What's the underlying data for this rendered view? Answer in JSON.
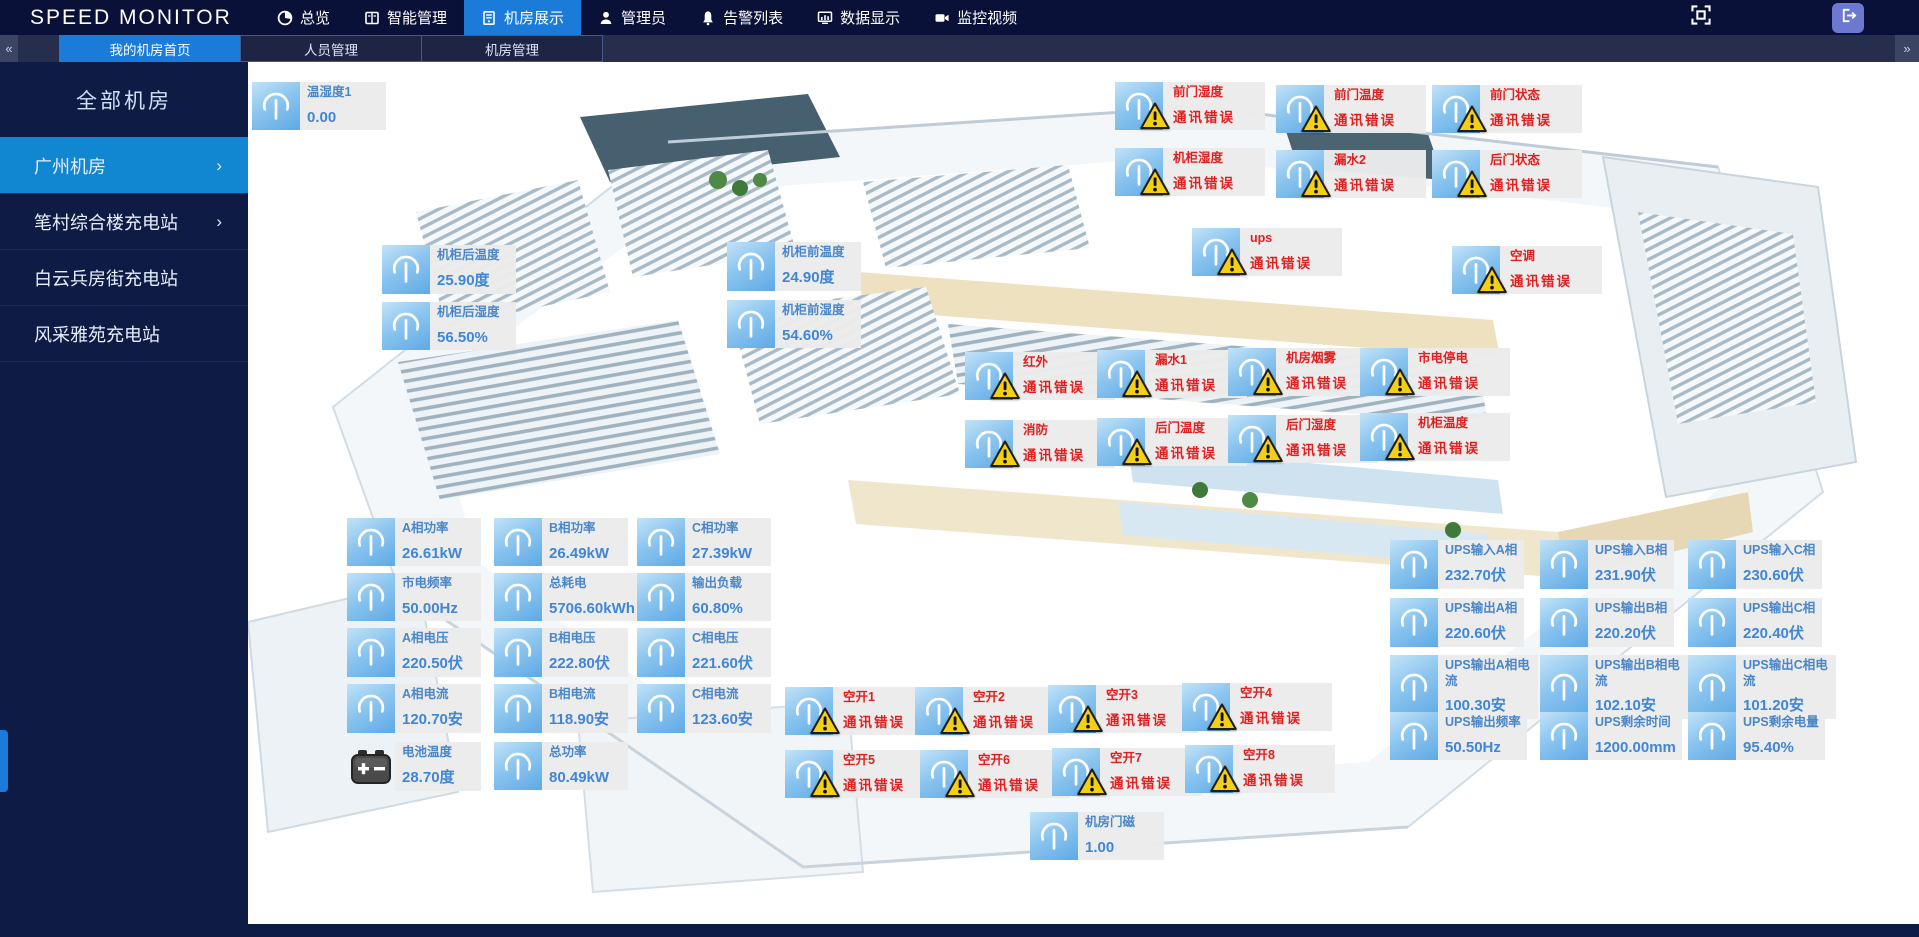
{
  "app": {
    "logo": "SPEED MONITOR"
  },
  "topnav": {
    "items": [
      {
        "label": "总览",
        "icon": "overview-icon",
        "active": false
      },
      {
        "label": "智能管理",
        "icon": "smart-management-icon",
        "active": false
      },
      {
        "label": "机房展示",
        "icon": "room-display-icon",
        "active": true
      },
      {
        "label": "管理员",
        "icon": "admin-icon",
        "active": false
      },
      {
        "label": "告警列表",
        "icon": "alarm-list-icon",
        "active": false
      },
      {
        "label": "数据显示",
        "icon": "data-display-icon",
        "active": false
      },
      {
        "label": "监控视频",
        "icon": "video-monitor-icon",
        "active": false
      }
    ]
  },
  "tabbar": {
    "left_chevron": "«",
    "right_chevron": "»",
    "tabs": [
      {
        "label": "我的机房首页",
        "active": true
      },
      {
        "label": "人员管理",
        "active": false
      },
      {
        "label": "机房管理",
        "active": false
      }
    ]
  },
  "sidebar": {
    "header": "全部机房",
    "items": [
      {
        "label": "广州机房",
        "active": true,
        "chevron": "›"
      },
      {
        "label": "笔村综合楼充电站",
        "active": false,
        "chevron": "›"
      },
      {
        "label": "白云兵房街充电站",
        "active": false,
        "chevron": ""
      },
      {
        "label": "风采雅苑充电站",
        "active": false,
        "chevron": ""
      }
    ]
  },
  "colors": {
    "accent": "#1a7bd9",
    "topbar_bg": "#0a1138",
    "sidebar_bg": "#0e1c45",
    "sidebar_active": "#1287d1",
    "error_red": "#e11f1f",
    "value_blue": "#3f86d6",
    "badge_bg": "#ebebeb",
    "icon_blue": "#8cc5ef",
    "warning_yellow": "#f3cf16"
  },
  "sensors": [
    {
      "label": "温湿度1",
      "value": "0.00",
      "icon": "gauge-icon",
      "x": 4,
      "y": 20
    },
    {
      "label": "机柜后温度",
      "value": "25.90度",
      "icon": "gauge-icon",
      "x": 134,
      "y": 183
    },
    {
      "label": "机柜后湿度",
      "value": "56.50%",
      "icon": "gauge-icon",
      "x": 134,
      "y": 240
    },
    {
      "label": "机柜前温度",
      "value": "24.90度",
      "icon": "gauge-icon",
      "x": 479,
      "y": 180
    },
    {
      "label": "机柜前湿度",
      "value": "54.60%",
      "icon": "gauge-icon",
      "x": 479,
      "y": 238
    },
    {
      "label": "A相功率",
      "value": "26.61kW",
      "icon": "gauge-icon",
      "x": 99,
      "y": 456
    },
    {
      "label": "B相功率",
      "value": "26.49kW",
      "icon": "gauge-icon",
      "x": 246,
      "y": 456
    },
    {
      "label": "C相功率",
      "value": "27.39kW",
      "icon": "gauge-icon",
      "x": 389,
      "y": 456
    },
    {
      "label": "市电频率",
      "value": "50.00Hz",
      "icon": "gauge-icon",
      "x": 99,
      "y": 511
    },
    {
      "label": "总耗电",
      "value": "5706.60kWh",
      "icon": "gauge-icon",
      "x": 246,
      "y": 511
    },
    {
      "label": "输出负载",
      "value": "60.80%",
      "icon": "gauge-icon",
      "x": 389,
      "y": 511
    },
    {
      "label": "A相电压",
      "value": "220.50伏",
      "icon": "gauge-icon",
      "x": 99,
      "y": 566
    },
    {
      "label": "B相电压",
      "value": "222.80伏",
      "icon": "gauge-icon",
      "x": 246,
      "y": 566
    },
    {
      "label": "C相电压",
      "value": "221.60伏",
      "icon": "gauge-icon",
      "x": 389,
      "y": 566
    },
    {
      "label": "A相电流",
      "value": "120.70安",
      "icon": "gauge-icon",
      "x": 99,
      "y": 622
    },
    {
      "label": "B相电流",
      "value": "118.90安",
      "icon": "gauge-icon",
      "x": 246,
      "y": 622
    },
    {
      "label": "C相电流",
      "value": "123.60安",
      "icon": "gauge-icon",
      "x": 389,
      "y": 622
    },
    {
      "label": "电池温度",
      "value": "28.70度",
      "icon": "battery-icon",
      "x": 99,
      "y": 680
    },
    {
      "label": "总功率",
      "value": "80.49kW",
      "icon": "gauge-icon",
      "x": 246,
      "y": 680
    },
    {
      "label": "UPS输入A相",
      "value": "232.70伏",
      "icon": "gauge-icon",
      "x": 1142,
      "y": 478
    },
    {
      "label": "UPS输入B相",
      "value": "231.90伏",
      "icon": "gauge-icon",
      "x": 1292,
      "y": 478
    },
    {
      "label": "UPS输入C相",
      "value": "230.60伏",
      "icon": "gauge-icon",
      "x": 1440,
      "y": 478
    },
    {
      "label": "UPS输出A相",
      "value": "220.60伏",
      "icon": "gauge-icon",
      "x": 1142,
      "y": 536
    },
    {
      "label": "UPS输出B相",
      "value": "220.20伏",
      "icon": "gauge-icon",
      "x": 1292,
      "y": 536
    },
    {
      "label": "UPS输出C相",
      "value": "220.40伏",
      "icon": "gauge-icon",
      "x": 1440,
      "y": 536
    },
    {
      "label": "UPS输出A相电流",
      "value": "100.30安",
      "icon": "gauge-icon",
      "x": 1142,
      "y": 593
    },
    {
      "label": "UPS输出B相电流",
      "value": "102.10安",
      "icon": "gauge-icon",
      "x": 1292,
      "y": 593
    },
    {
      "label": "UPS输出C相电流",
      "value": "101.20安",
      "icon": "gauge-icon",
      "x": 1440,
      "y": 593
    },
    {
      "label": "UPS输出频率",
      "value": "50.50Hz",
      "icon": "gauge-icon",
      "x": 1142,
      "y": 650
    },
    {
      "label": "UPS剩余时间",
      "value": "1200.00mm",
      "icon": "gauge-icon",
      "x": 1292,
      "y": 650
    },
    {
      "label": "UPS剩余电量",
      "value": "95.40%",
      "icon": "gauge-icon",
      "x": 1440,
      "y": 650
    },
    {
      "label": "机房门磁",
      "value": "1.00",
      "icon": "gauge-icon",
      "x": 782,
      "y": 750
    },
    {
      "label": "前门湿度",
      "status": "通讯错误",
      "icon": "gauge-icon",
      "x": 867,
      "y": 20
    },
    {
      "label": "前门温度",
      "status": "通讯错误",
      "icon": "gauge-icon",
      "x": 1028,
      "y": 23
    },
    {
      "label": "前门状态",
      "status": "通讯错误",
      "icon": "gauge-icon",
      "x": 1184,
      "y": 23
    },
    {
      "label": "机柜湿度",
      "status": "通讯错误",
      "icon": "gauge-icon",
      "x": 867,
      "y": 86
    },
    {
      "label": "漏水2",
      "status": "通讯错误",
      "icon": "gauge-icon",
      "x": 1028,
      "y": 88
    },
    {
      "label": "后门状态",
      "status": "通讯错误",
      "icon": "gauge-icon",
      "x": 1184,
      "y": 88
    },
    {
      "label": "ups",
      "status": "通讯错误",
      "icon": "gauge-icon",
      "x": 944,
      "y": 166
    },
    {
      "label": "空调",
      "status": "通讯错误",
      "icon": "gauge-icon",
      "x": 1204,
      "y": 184
    },
    {
      "label": "红外",
      "status": "通讯错误",
      "icon": "gauge-icon",
      "x": 717,
      "y": 290
    },
    {
      "label": "漏水1",
      "status": "通讯错误",
      "icon": "gauge-icon",
      "x": 849,
      "y": 288
    },
    {
      "label": "机房烟雾",
      "status": "通讯错误",
      "icon": "gauge-icon",
      "x": 980,
      "y": 286
    },
    {
      "label": "市电停电",
      "status": "通讯错误",
      "icon": "gauge-icon",
      "x": 1112,
      "y": 286
    },
    {
      "label": "消防",
      "status": "通讯错误",
      "icon": "gauge-icon",
      "x": 717,
      "y": 358
    },
    {
      "label": "后门温度",
      "status": "通讯错误",
      "icon": "gauge-icon",
      "x": 849,
      "y": 356
    },
    {
      "label": "后门湿度",
      "status": "通讯错误",
      "icon": "gauge-icon",
      "x": 980,
      "y": 353
    },
    {
      "label": "机柜温度",
      "status": "通讯错误",
      "icon": "gauge-icon",
      "x": 1112,
      "y": 351
    },
    {
      "label": "空开1",
      "status": "通讯错误",
      "icon": "gauge-icon",
      "x": 537,
      "y": 625
    },
    {
      "label": "空开2",
      "status": "通讯错误",
      "icon": "gauge-icon",
      "x": 667,
      "y": 625
    },
    {
      "label": "空开3",
      "status": "通讯错误",
      "icon": "gauge-icon",
      "x": 800,
      "y": 623
    },
    {
      "label": "空开4",
      "status": "通讯错误",
      "icon": "gauge-icon",
      "x": 934,
      "y": 621
    },
    {
      "label": "空开5",
      "status": "通讯错误",
      "icon": "gauge-icon",
      "x": 537,
      "y": 688
    },
    {
      "label": "空开6",
      "status": "通讯错误",
      "icon": "gauge-icon",
      "x": 672,
      "y": 688
    },
    {
      "label": "空开7",
      "status": "通讯错误",
      "icon": "gauge-icon",
      "x": 804,
      "y": 686
    },
    {
      "label": "空开8",
      "status": "通讯错误",
      "icon": "gauge-icon",
      "x": 937,
      "y": 683
    }
  ]
}
